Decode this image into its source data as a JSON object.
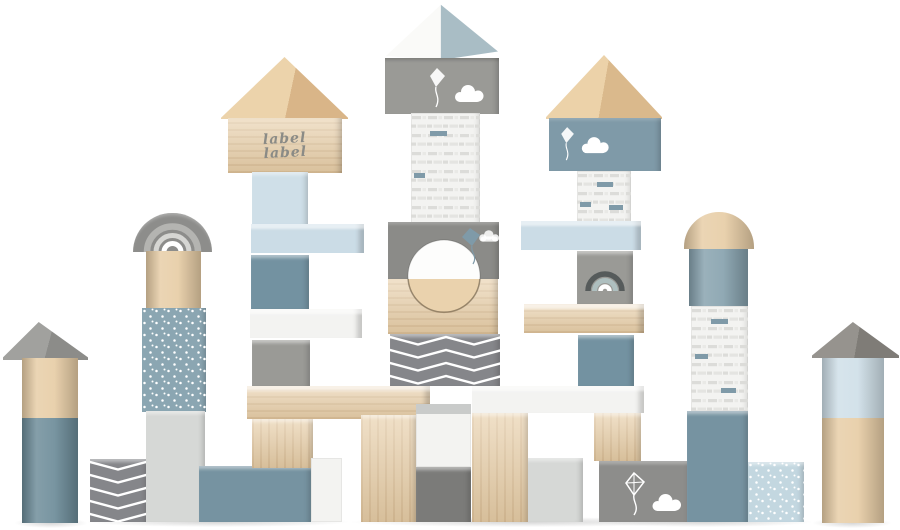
{
  "stamp": {
    "line1": "label",
    "line2": "label"
  },
  "palette": {
    "bg": "#ffffff",
    "wood-mid": "#e7cda6",
    "wood-deep": "#d9b88d",
    "white-block": "#f3f3f1",
    "light-gray": "#d6d8d6",
    "mid-gray": "#9a9a96",
    "dark-gray": "#7b7b79",
    "chevron-gray": "#85868a",
    "circle-gray": "#8b8b88",
    "rainbow-gray": "#8d8d8b",
    "roof-blue": "#a9bdc5",
    "steel-blue": "#7392a1",
    "steel-blue-light": "#7f9aa8",
    "blue-block": "#7693a1",
    "deep-blue": "#6d8c99",
    "cyl-blue": "#87a2ae",
    "dotted-blue": "#8ba6b2",
    "light-blue": "#cbdce6",
    "pale-blue": "#cfdfe8",
    "dotted-cube-blue": "#c3d7e0",
    "pattern-dash": "#dcdcd9",
    "stamp-gray": "#8b8b86"
  },
  "icons": {
    "kite-icon": "diamond kite with curling string",
    "cloud-icon": "puffy cloud",
    "rainbow-icon": "three-band arch rainbow",
    "chevron-pattern": "white zigzag chevron stripes",
    "birch-pattern": "rows of short dash bricks",
    "dots-pattern": "scattered white dots"
  },
  "scene": {
    "subject": "wooden toy building blocks stacked as a castle",
    "blocks": [
      {
        "name": "far-left-tower",
        "parts": [
          "gray triangle roof",
          "natural wood cylinder",
          "blue cylinder"
        ]
      },
      {
        "name": "left-chevron-cube",
        "color": "chevron-gray",
        "pattern": "chevron"
      },
      {
        "name": "rainbow-arch-block",
        "color": "rainbow-gray",
        "pattern": "rainbow"
      },
      {
        "name": "rainbow-tower",
        "parts": [
          "wood cylinder",
          "dotted blue block",
          "light gray block"
        ]
      },
      {
        "name": "label-house",
        "color": "wood-mid",
        "stamp": "label label"
      },
      {
        "name": "label-column",
        "parts": [
          "light blue cube",
          "light blue plank",
          "steel blue cube",
          "white plank",
          "gray cube",
          "wood plank"
        ]
      },
      {
        "name": "center-tower",
        "parts": [
          "white and blue roof",
          "gray kite block",
          "birch white column",
          "gray block with round hole",
          "wood block",
          "chevron block"
        ]
      },
      {
        "name": "right-house-tower",
        "parts": [
          "wood roof",
          "steel blue kite block",
          "birch cube",
          "light blue plank",
          "gray rainbow cube",
          "wood plank",
          "steel blue cube",
          "white plank"
        ]
      },
      {
        "name": "right-cylinder-tower",
        "parts": [
          "wood dome",
          "blue cylinder",
          "birch column",
          "blue base block"
        ]
      },
      {
        "name": "bottom-colonnade",
        "parts": [
          "wood columns",
          "white cube",
          "dark gray cube",
          "light gray cube",
          "blue long block",
          "gray kite block",
          "dotted light blue cube"
        ]
      },
      {
        "name": "far-right-tower",
        "parts": [
          "gray triangle roof",
          "light blue cylinder",
          "natural wood cylinder"
        ]
      }
    ]
  }
}
